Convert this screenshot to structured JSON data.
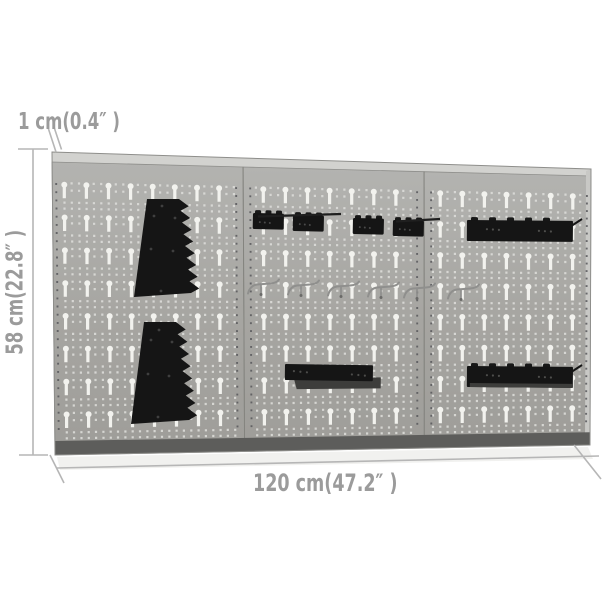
{
  "image_type": "product dimension photo",
  "product": {
    "name": "wall-mounted pegboard panel set with tool holders",
    "panel_count": 3,
    "panels": [
      "left",
      "middle",
      "right"
    ]
  },
  "dimensions": {
    "thickness": "1 cm(0.4″ )",
    "height": "58 cm(22.8″ )",
    "width": "120 cm(47.2″ )"
  },
  "accessories": [
    {
      "name": "screwdriver-rack-upper",
      "type": "serrated trapezoid rack",
      "color": "black"
    },
    {
      "name": "screwdriver-rack-lower",
      "type": "serrated trapezoid rack",
      "color": "black"
    },
    {
      "name": "hook-rail-1",
      "type": "hook rail bracket",
      "color": "black"
    },
    {
      "name": "hook-rail-2",
      "type": "hook rail bracket",
      "color": "black"
    },
    {
      "name": "hook-rail-3",
      "type": "hook rail bracket",
      "color": "black"
    },
    {
      "name": "hook-rail-4",
      "type": "hook rail bracket",
      "color": "black"
    },
    {
      "name": "wire-hooks",
      "type": "wire tool hook",
      "count": 6,
      "color": "gray"
    },
    {
      "name": "shelf-bracket-middle",
      "type": "shelf bracket",
      "color": "black"
    },
    {
      "name": "shelf-rail-right-top",
      "type": "long rail bracket",
      "color": "black"
    },
    {
      "name": "shelf-rail-right-bottom",
      "type": "long rail bracket",
      "color": "black"
    }
  ],
  "colors": {
    "background": "#ffffff",
    "panel_top": "#b3b3b0",
    "panel_mid": "#a6a5a1",
    "panel_bottom": "#9e9d99",
    "panel_edge": "#8e8e8b",
    "fold_light": "#d2d2cf",
    "right_fold": "#c8c8c5",
    "seam_line": "#84847f",
    "hole_white": "#f2f2ee",
    "dot_white": "#dcdcd8",
    "mount_dot": "#57575a",
    "bottom_strip": "#5d5d5b",
    "accessory_black": "#151515",
    "accessory_dark": "#3d3d3b",
    "wire_gray": "#8f8f8d",
    "dim_line": "#b6b6b6",
    "dim_text": "#9b9b9b",
    "shadow": "#f1f1ef"
  }
}
